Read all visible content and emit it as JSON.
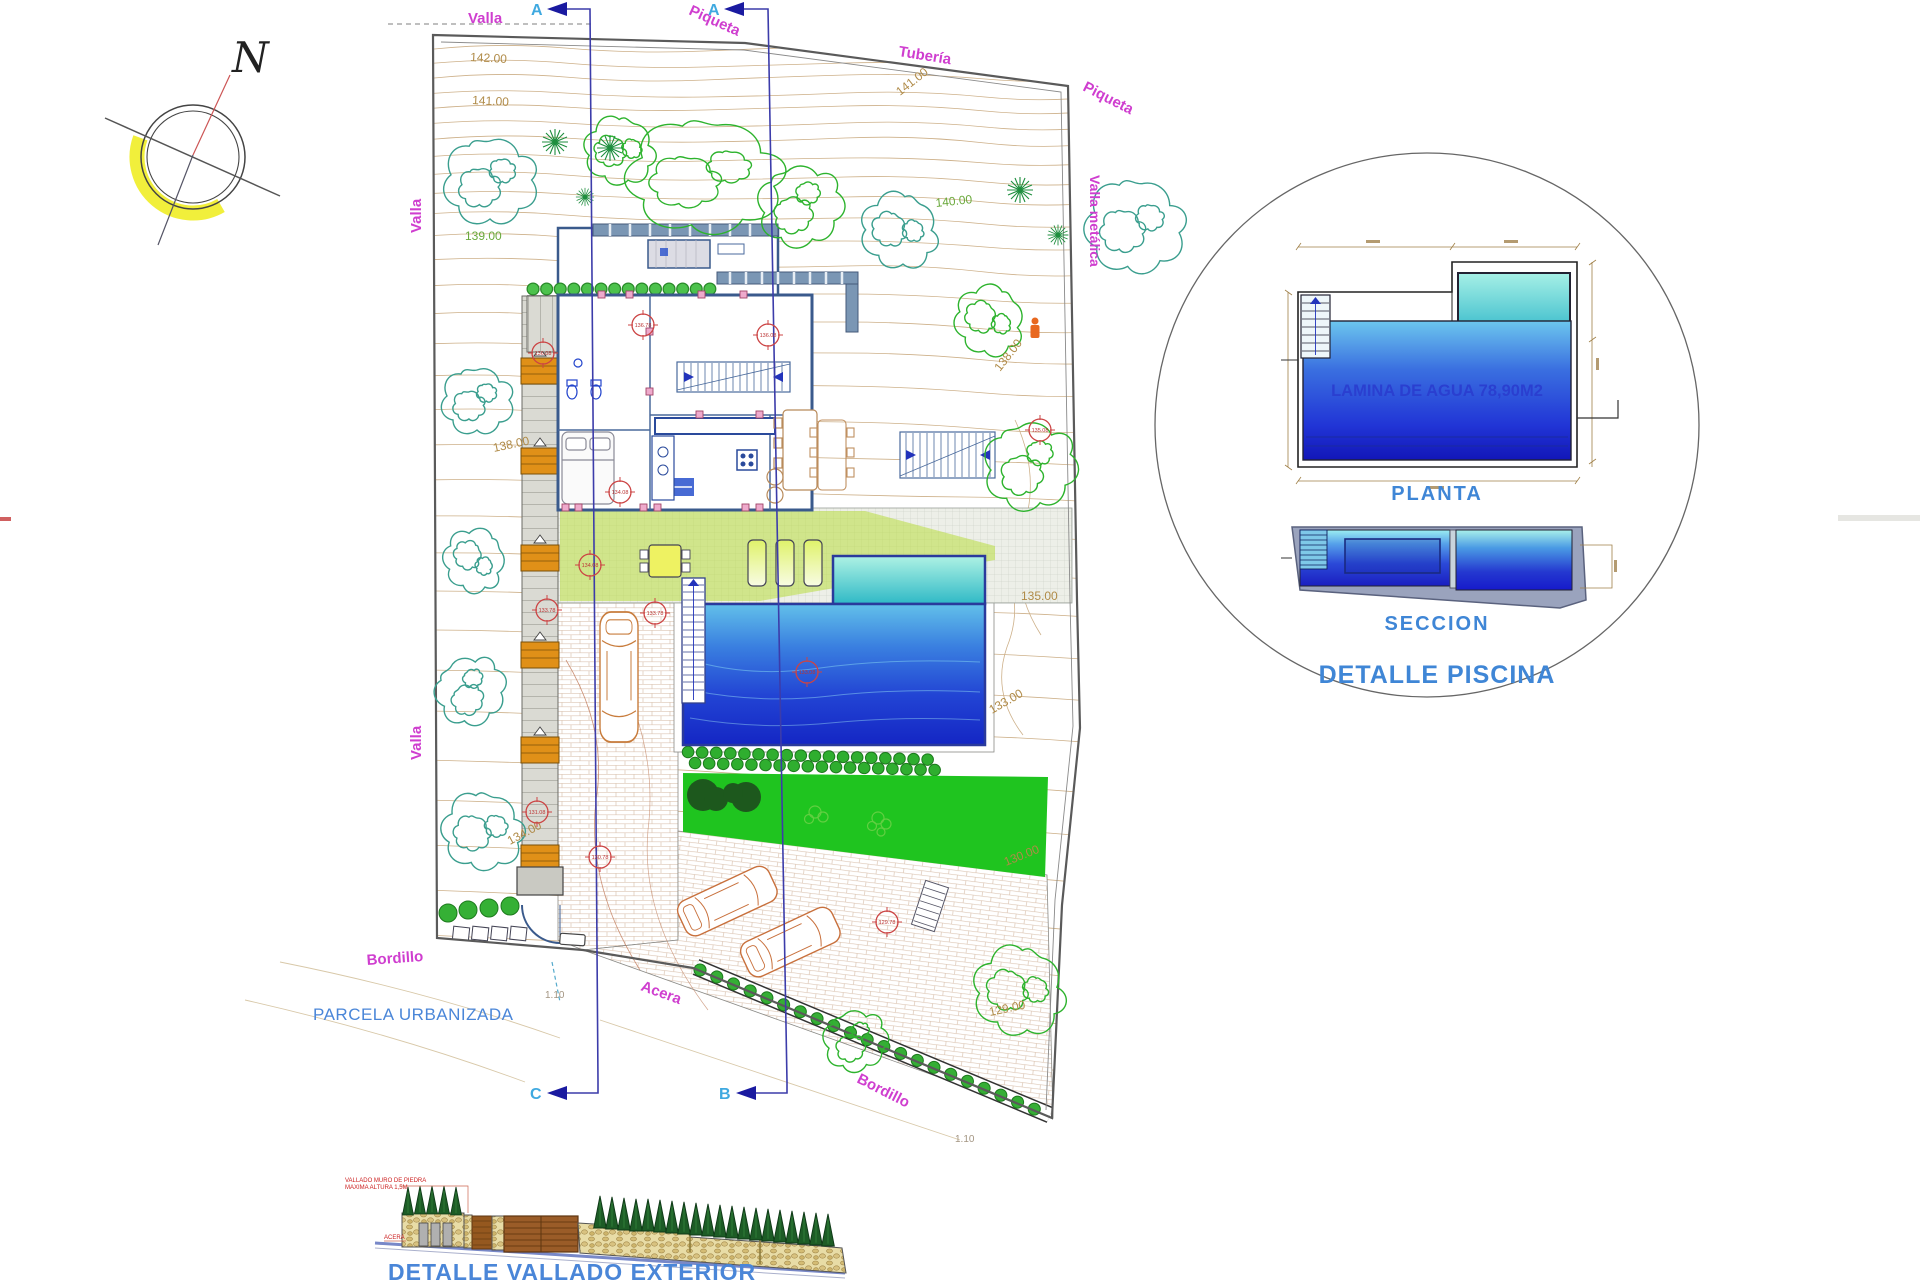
{
  "compass": {
    "north": "N"
  },
  "plan": {
    "boundary_labels": {
      "valla_top": "Valla",
      "piqueta_top": "Piqueta",
      "tuberia": "Tubería",
      "piqueta_right": "Piqueta",
      "valla_metalica": "Valla metálica",
      "valla_left_upper": "Valla",
      "valla_left_lower": "Valla",
      "bordillo_left": "Bordillo",
      "bordillo_right": "Bordillo",
      "acera": "Acera",
      "parcela": "PARCELA URBANIZADA"
    },
    "section_markers": {
      "top_left": "A",
      "top_right": "A",
      "bottom_left": "C",
      "bottom_right": "B"
    },
    "contour_labels": [
      {
        "value": "142.00"
      },
      {
        "value": "141.00"
      },
      {
        "value": "141.00"
      },
      {
        "value": "140.00"
      },
      {
        "value": "139.00"
      },
      {
        "value": "138.00"
      },
      {
        "value": "138.00"
      },
      {
        "value": "135.00"
      },
      {
        "value": "134.00"
      },
      {
        "value": "133.00"
      },
      {
        "value": "130.00"
      },
      {
        "value": "129.00"
      },
      {
        "value": "1.10"
      },
      {
        "value": "1.10"
      }
    ],
    "level_markers": [
      "136.08",
      "136.78",
      "136.08",
      "135.08",
      "134.08",
      "134.08",
      "133.78",
      "133.78",
      "133.08",
      "131.08",
      "130.78",
      "129.78"
    ]
  },
  "pool_detail": {
    "water_area_label": "LAMINA DE AGUA 78,90M2",
    "planta_label": "PLANTA",
    "seccion_label": "SECCION",
    "title": "DETALLE PISCINA"
  },
  "fence_detail": {
    "note_line1": "VALLADO MURO DE PIEDRA",
    "note_line2": "MAXIMA ALTURA 1,5M",
    "acera_label": "ACERA",
    "title": "DETALLE VALLADO EXTERIOR"
  }
}
